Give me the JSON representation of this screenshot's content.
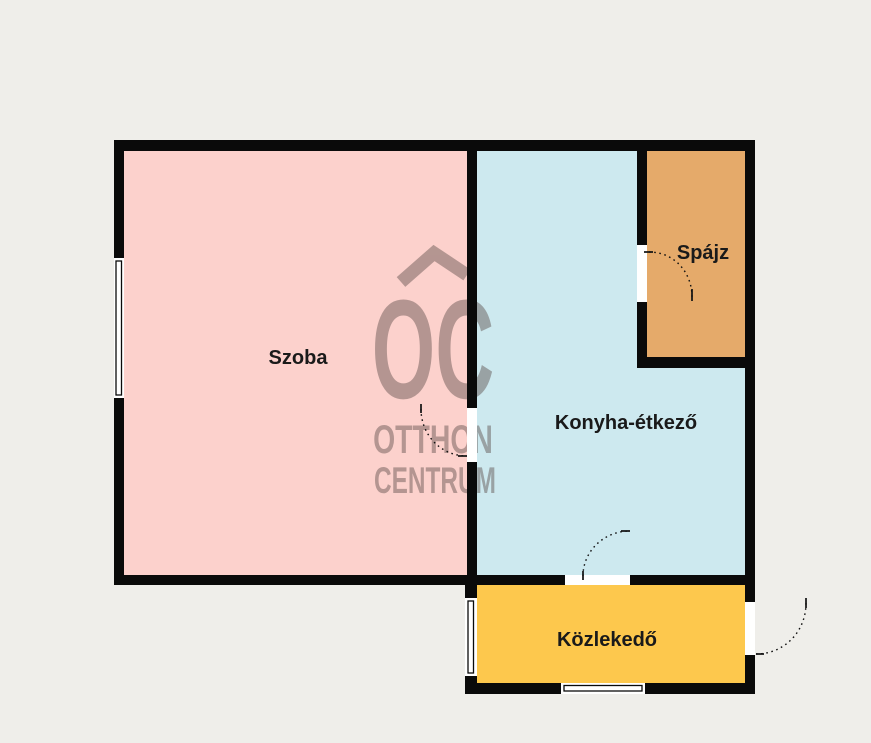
{
  "plan": {
    "background_color": "#efeeea",
    "wall_color": "#0a0a0a",
    "door_arc_color": "#111111",
    "window_fill": "#ffffff",
    "label_color": "#1a1a1a",
    "rooms": [
      {
        "label": "Szoba",
        "color": "#fcd1cc"
      },
      {
        "label": "Konyha-étkező",
        "color": "#cde9ef"
      },
      {
        "label": "Spájz",
        "color": "#e5aa6a"
      },
      {
        "label": "Közlekedő",
        "color": "#fdc84d"
      }
    ],
    "watermark": {
      "logo": "OC",
      "line1": "OTTHON",
      "line2": "CENTRUM",
      "color": "#564744"
    }
  }
}
